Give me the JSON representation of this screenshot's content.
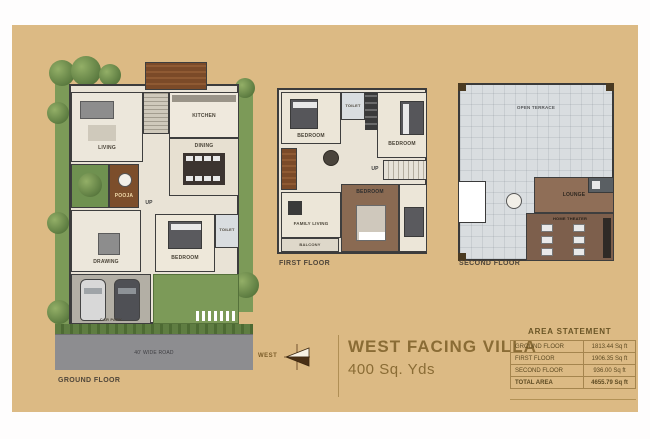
{
  "colors": {
    "board_bg": "#dcba84",
    "accent_brown": "#8a6c35",
    "table_border": "#a5854e"
  },
  "plans": {
    "ground": {
      "label": "GROUND FLOOR",
      "rooms": {
        "living": "LIVING",
        "kitchen": "KITCHEN",
        "dining": "DINING",
        "pooja": "POOJA",
        "drawing": "DRAWING",
        "bedroom": "BEDROOM",
        "toilet": "TOILET",
        "carpark": "CAR PARK",
        "up": "UP",
        "road": "40' WIDE ROAD"
      }
    },
    "first": {
      "label": "FIRST FLOOR",
      "rooms": {
        "bedroom1": "BEDROOM",
        "toilet1": "TOILET",
        "bedroom2": "BEDROOM",
        "family": "FAMILY LIVING",
        "bedroom3": "BEDROOM",
        "balcony": "BALCONY",
        "up": "UP"
      }
    },
    "second": {
      "label": "SECOND FLOOR",
      "rooms": {
        "terrace": "OPEN TERRACE",
        "lounge": "LOUNGE",
        "theater": "HOME THEATER"
      }
    }
  },
  "title_block": {
    "title": "WEST FACING VILLA",
    "subtitle": "400 Sq. Yds",
    "compass_label": "WEST"
  },
  "area_statement": {
    "header": "AREA STATEMENT",
    "rows": [
      {
        "label": "GROUND FLOOR",
        "value": "1813.44 Sq ft"
      },
      {
        "label": "FIRST FLOOR",
        "value": "1906.35 Sq ft"
      },
      {
        "label": "SECOND FLOOR",
        "value": "936.00 Sq ft"
      },
      {
        "label": "TOTAL AREA",
        "value": "4655.79 Sq ft"
      }
    ]
  }
}
